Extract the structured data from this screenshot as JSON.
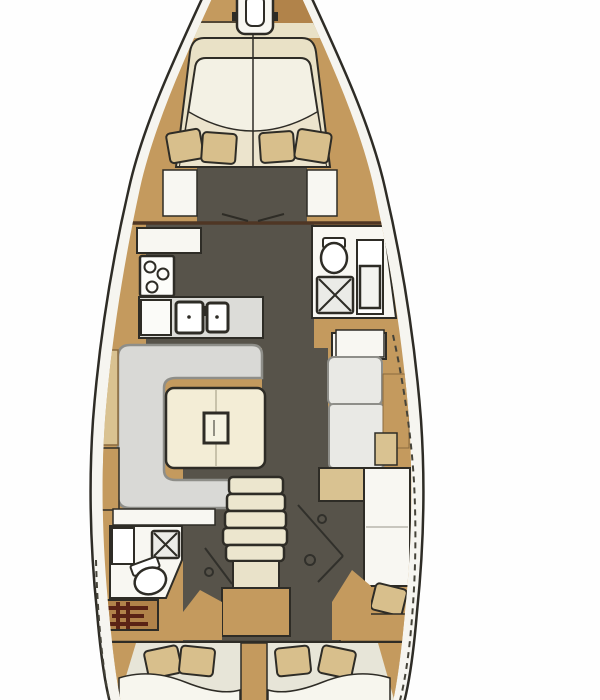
{
  "plan": {
    "title": "Sailing yacht interior layout — top-view floor plan",
    "orientation": "bow-top-stern-bottom",
    "sections": [
      {
        "name": "bow-deck",
        "fixtures": [
          "anchor-windlass-icon"
        ]
      },
      {
        "name": "forward-cabin",
        "fixtures": [
          "island-double-berth",
          "duvet-fold-line",
          "pillow-icon-x4",
          "wardrobe-port",
          "wardrobe-starboard"
        ]
      },
      {
        "name": "galley-port",
        "fixtures": [
          "three-burner-stove-icon",
          "double-sink-icon",
          "refrigerator",
          "worktop"
        ]
      },
      {
        "name": "forward-head-starboard",
        "fixtures": [
          "toilet-icon",
          "shower-grate-icon",
          "washbasin-vanity"
        ]
      },
      {
        "name": "salon",
        "fixtures": [
          "u-shaped-settee",
          "dining-table",
          "mast-post",
          "starboard-settee",
          "chart-desk",
          "side-lockers"
        ]
      },
      {
        "name": "companionway",
        "fixtures": [
          "stairs-5-treads",
          "engine-compartment",
          "steering-gear-lines"
        ]
      },
      {
        "name": "aft-head-port",
        "fixtures": [
          "toilet-icon",
          "shower-grate-icon",
          "washbasin",
          "heater-unit-symbol"
        ]
      },
      {
        "name": "aft-cabin-port",
        "fixtures": [
          "double-berth",
          "pillow-icon-x2"
        ]
      },
      {
        "name": "aft-cabin-starboard",
        "fixtures": [
          "double-berth",
          "pillow-icon-x2",
          "seat-cushion-pillow"
        ]
      }
    ]
  },
  "palette": {
    "bg": "#fefefe",
    "ink": "#2e2c26",
    "hull_fill": "#f6f5f0",
    "wood": "#c49a5e",
    "wood_dark": "#b1834a",
    "wood_light": "#d9c291",
    "wood_line": "#8a6b3f",
    "cream": "#e9e1c6",
    "bed": "#f3f1e4",
    "bed_lower": "#ece4cd",
    "pillow": "#d8bf8c",
    "floor": "#57534a",
    "settee": "#d9d9d6",
    "settee_line": "#8e8e89",
    "table": "#f3edd6",
    "fixture_white": "#f8f7f2",
    "steel": "#dcdcd8",
    "pale_aft": "#e7e5d8",
    "bulkhead": "#4f3624",
    "glyph_red": "#5a2315"
  }
}
